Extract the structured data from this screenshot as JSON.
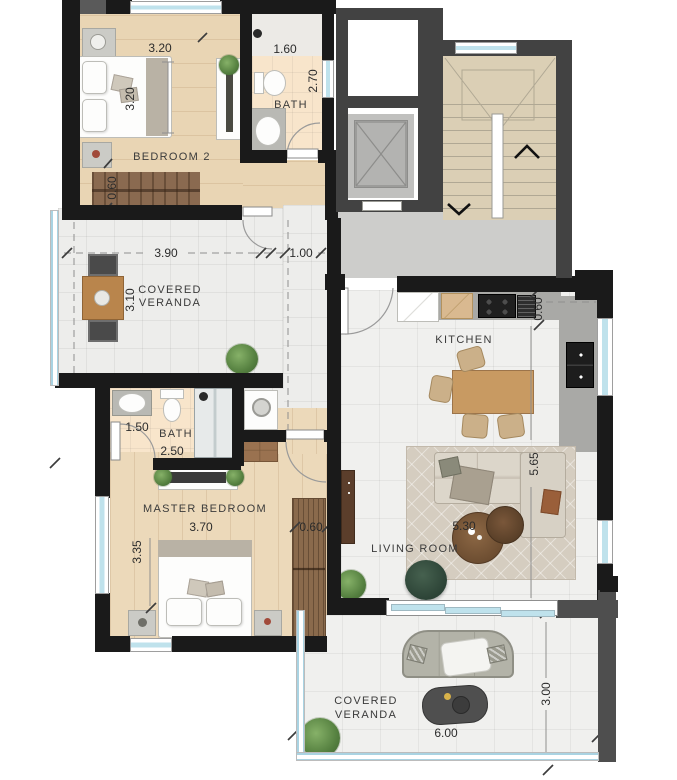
{
  "plan_title": "apartment-floor-plan",
  "rooms": {
    "bedroom2": {
      "label": "BEDROOM 2",
      "dim_width": "3.20",
      "dim_depth": "3.20",
      "dim_rug": "0.60"
    },
    "bathTop": {
      "label": "BATH",
      "dim_width": "1.60",
      "dim_depth": "2.70"
    },
    "verandaLeft": {
      "label_line1": "COVERED",
      "label_line2": "VERANDA",
      "dim_width": "3.90",
      "dim_depth": "3.10"
    },
    "hall": {
      "dim_width": "1.00"
    },
    "kitchen": {
      "label": "KITCHEN",
      "dim_counter": "0.60"
    },
    "living": {
      "label": "LIVING ROOM",
      "dim_depth": "5.65",
      "dim_width": "5.30"
    },
    "bathMaster": {
      "label": "BATH",
      "dim_width": "1.50",
      "dim_depth": "2.50"
    },
    "master": {
      "label": "MASTER BEDROOM",
      "dim_width": "3.70",
      "dim_depth": "3.35",
      "dim_wardrobe": "0.60"
    },
    "verandaBottom": {
      "label_line1": "COVERED",
      "label_line2": "VERANDA",
      "dim_width": "6.00",
      "dim_depth": "3.00"
    }
  },
  "colors": {
    "wall": "#1a1a1a",
    "common_wall": "#424242",
    "glass": "#bfe2ec",
    "wood": "#e9d5b4",
    "bath_floor": "#f8e5cb",
    "stair_floor": "#dbcfb5"
  }
}
